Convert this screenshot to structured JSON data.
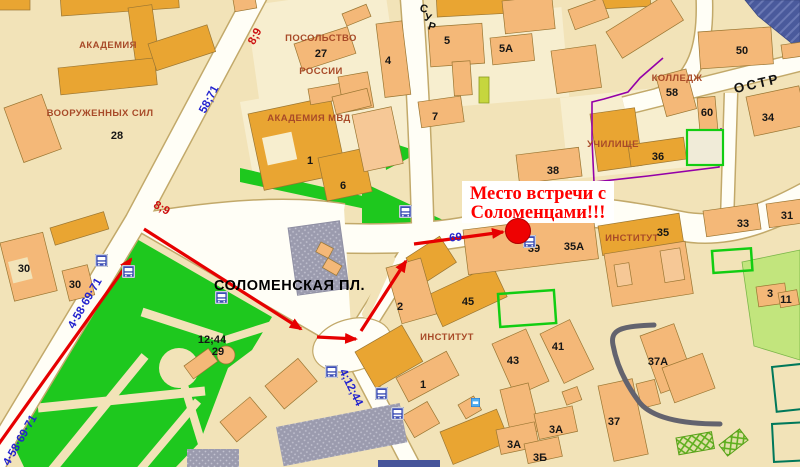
{
  "annotation": {
    "line1": "Место встречи с",
    "line2": "Соломенцами!!!"
  },
  "marker": {
    "x": 518,
    "y": 231,
    "color": "#EE0202"
  },
  "streets": {
    "sur": "СУР",
    "ostr": "ОСТР",
    "square": "СОЛОМЕНСКАЯ ПЛ."
  },
  "colors": {
    "background": "#F2E3B8",
    "road": "#FFFEF6",
    "park": "#1EC81E",
    "building_light": "#F4B878",
    "building_dark": "#E9A532",
    "route_red": "#E60000",
    "route_blue": "#2222CE",
    "poi_label": "#A84A28",
    "marker_red": "#EE0202",
    "annotation_red": "#FF0000"
  },
  "labels": [
    {
      "name": "label-akademia",
      "text": "АКАДЕМИЯ",
      "x": 108,
      "y": 48,
      "cls": "poi"
    },
    {
      "name": "label-vooruzhennyh-sil",
      "text": "ВООРУЖЕННЫХ СИЛ",
      "x": 100,
      "y": 116,
      "cls": "poi"
    },
    {
      "name": "label-posolstvo",
      "text": "ПОСОЛЬСТВО",
      "x": 321,
      "y": 41,
      "cls": "poi"
    },
    {
      "name": "label-rossii",
      "text": "РОССИИ",
      "x": 321,
      "y": 74,
      "cls": "poi"
    },
    {
      "name": "label-akademia-mvd",
      "text": "АКАДЕМИЯ МВД",
      "x": 309,
      "y": 121,
      "cls": "poi"
    },
    {
      "name": "label-kolledzh",
      "text": "КОЛЛЕДЖ",
      "x": 677,
      "y": 81,
      "cls": "poi"
    },
    {
      "name": "label-uchilishche",
      "text": "УЧИЛИЩЕ",
      "x": 613,
      "y": 147,
      "cls": "poi"
    },
    {
      "name": "label-institut-right",
      "text": "ИНСТИТУТ",
      "x": 632,
      "y": 241,
      "cls": "poi"
    },
    {
      "name": "label-institut-center",
      "text": "ИНСТИТУТ",
      "x": 447,
      "y": 340,
      "cls": "poi"
    },
    {
      "name": "square-name",
      "text": "СОЛОМЕНСКАЯ ПЛ.",
      "x": 214,
      "y": 290,
      "cls": "square-name"
    },
    {
      "name": "street-ostr",
      "text": "ОСТР",
      "x": 758,
      "y": 88,
      "rot": -13,
      "cls": "street-lg"
    },
    {
      "name": "street-sur-letter",
      "text": "С",
      "x": 423,
      "y": 12,
      "rot": 15,
      "cls": "street"
    },
    {
      "name": "street-sur-letter",
      "text": "У",
      "x": 427,
      "y": 21,
      "rot": 15,
      "cls": "street"
    },
    {
      "name": "street-sur-letter",
      "text": "Р",
      "x": 431,
      "y": 30,
      "rot": 15,
      "cls": "street"
    },
    {
      "name": "building-number",
      "text": "28",
      "x": 117,
      "y": 139,
      "cls": "num"
    },
    {
      "name": "building-number",
      "text": "30",
      "x": 24,
      "y": 272,
      "cls": "num"
    },
    {
      "name": "building-number",
      "text": "30",
      "x": 75,
      "y": 288,
      "cls": "num"
    },
    {
      "name": "building-number",
      "text": "27",
      "x": 321,
      "y": 57,
      "cls": "num"
    },
    {
      "name": "building-number",
      "text": "4",
      "x": 388,
      "y": 64,
      "cls": "num"
    },
    {
      "name": "building-number",
      "text": "5",
      "x": 447,
      "y": 44,
      "cls": "num"
    },
    {
      "name": "building-number",
      "text": "5А",
      "x": 506,
      "y": 52,
      "cls": "num"
    },
    {
      "name": "building-number",
      "text": "7",
      "x": 435,
      "y": 120,
      "cls": "num"
    },
    {
      "name": "building-number",
      "text": "50",
      "x": 742,
      "y": 54,
      "cls": "num"
    },
    {
      "name": "building-number",
      "text": "58",
      "x": 672,
      "y": 96,
      "cls": "num"
    },
    {
      "name": "building-number",
      "text": "60",
      "x": 707,
      "y": 116,
      "cls": "num"
    },
    {
      "name": "building-number",
      "text": "34",
      "x": 768,
      "y": 121,
      "cls": "num"
    },
    {
      "name": "building-number",
      "text": "36",
      "x": 658,
      "y": 160,
      "cls": "num"
    },
    {
      "name": "building-number",
      "text": "38",
      "x": 553,
      "y": 174,
      "cls": "num"
    },
    {
      "name": "building-number",
      "text": "1",
      "x": 310,
      "y": 164,
      "cls": "num"
    },
    {
      "name": "building-number",
      "text": "6",
      "x": 343,
      "y": 189,
      "cls": "num"
    },
    {
      "name": "building-number",
      "text": "2",
      "x": 400,
      "y": 310,
      "cls": "num"
    },
    {
      "name": "building-number",
      "text": "45",
      "x": 468,
      "y": 305,
      "cls": "num"
    },
    {
      "name": "building-number",
      "text": "35",
      "x": 663,
      "y": 236,
      "cls": "num"
    },
    {
      "name": "building-number",
      "text": "35А",
      "x": 574,
      "y": 250,
      "cls": "num"
    },
    {
      "name": "building-number",
      "text": "39",
      "x": 534,
      "y": 252,
      "cls": "num"
    },
    {
      "name": "building-number",
      "text": "33",
      "x": 743,
      "y": 227,
      "cls": "num"
    },
    {
      "name": "building-number",
      "text": "31",
      "x": 787,
      "y": 219,
      "cls": "num"
    },
    {
      "name": "building-number",
      "text": "3",
      "x": 770,
      "y": 297,
      "cls": "num"
    },
    {
      "name": "building-number",
      "text": "43",
      "x": 513,
      "y": 364,
      "cls": "num"
    },
    {
      "name": "building-number",
      "text": "41",
      "x": 558,
      "y": 350,
      "cls": "num"
    },
    {
      "name": "building-number",
      "text": "37А",
      "x": 658,
      "y": 365,
      "cls": "num"
    },
    {
      "name": "building-number",
      "text": "37",
      "x": 614,
      "y": 425,
      "cls": "num"
    },
    {
      "name": "building-number",
      "text": "1",
      "x": 423,
      "y": 388,
      "cls": "num"
    },
    {
      "name": "building-number",
      "text": "3А",
      "x": 556,
      "y": 433,
      "cls": "num"
    },
    {
      "name": "building-number",
      "text": "3А",
      "x": 514,
      "y": 448,
      "cls": "num"
    },
    {
      "name": "building-number",
      "text": "3Б",
      "x": 540,
      "y": 461,
      "cls": "num"
    },
    {
      "name": "building-number",
      "text": "11",
      "x": 786,
      "y": 303,
      "cls": "num"
    },
    {
      "name": "building-number",
      "text": "29",
      "x": 218,
      "y": 355,
      "cls": "num"
    },
    {
      "name": "tram-routes",
      "text": "12;44",
      "x": 212,
      "y": 343,
      "cls": "num"
    },
    {
      "name": "route-number",
      "text": "58;71",
      "x": 212,
      "y": 101,
      "rot": -62,
      "cls": "route-blue"
    },
    {
      "name": "route-number",
      "text": "4·58·69·71",
      "x": 88,
      "y": 305,
      "rot": -60,
      "cls": "route-blue"
    },
    {
      "name": "route-number",
      "text": "4·58·69·71",
      "x": 23,
      "y": 442,
      "rot": -60,
      "cls": "route-blue"
    },
    {
      "name": "route-number",
      "text": "69",
      "x": 456,
      "y": 241,
      "rot": -6,
      "cls": "route-blue"
    },
    {
      "name": "route-number",
      "text": "4;12;44",
      "x": 348,
      "y": 389,
      "rot": 64,
      "cls": "route-blue"
    },
    {
      "name": "route-number",
      "text": "8;9",
      "x": 258,
      "y": 38,
      "rot": -62,
      "cls": "route-red"
    },
    {
      "name": "route-number",
      "text": "8;9",
      "x": 160,
      "y": 211,
      "rot": 30,
      "cls": "route-red"
    }
  ],
  "transit_icons": [
    {
      "name": "trolleybus-stop-icon",
      "type": "stop",
      "x": 95,
      "y": 254
    },
    {
      "name": "bus-stop-icon",
      "type": "stop",
      "x": 122,
      "y": 265
    },
    {
      "name": "tram-stop-icon",
      "type": "stop",
      "x": 215,
      "y": 291
    },
    {
      "name": "bus-stop-icon",
      "type": "stop",
      "x": 399,
      "y": 205
    },
    {
      "name": "trolleybus-stop-icon",
      "type": "stop",
      "x": 523,
      "y": 235
    },
    {
      "name": "tram-stop-icon",
      "type": "stop",
      "x": 325,
      "y": 365
    },
    {
      "name": "tram-stop-icon",
      "type": "stop",
      "x": 375,
      "y": 387
    },
    {
      "name": "tram-stop-icon",
      "type": "stop",
      "x": 391,
      "y": 407
    },
    {
      "name": "kiosk-icon",
      "type": "kiosk",
      "x": 471,
      "y": 398
    }
  ]
}
